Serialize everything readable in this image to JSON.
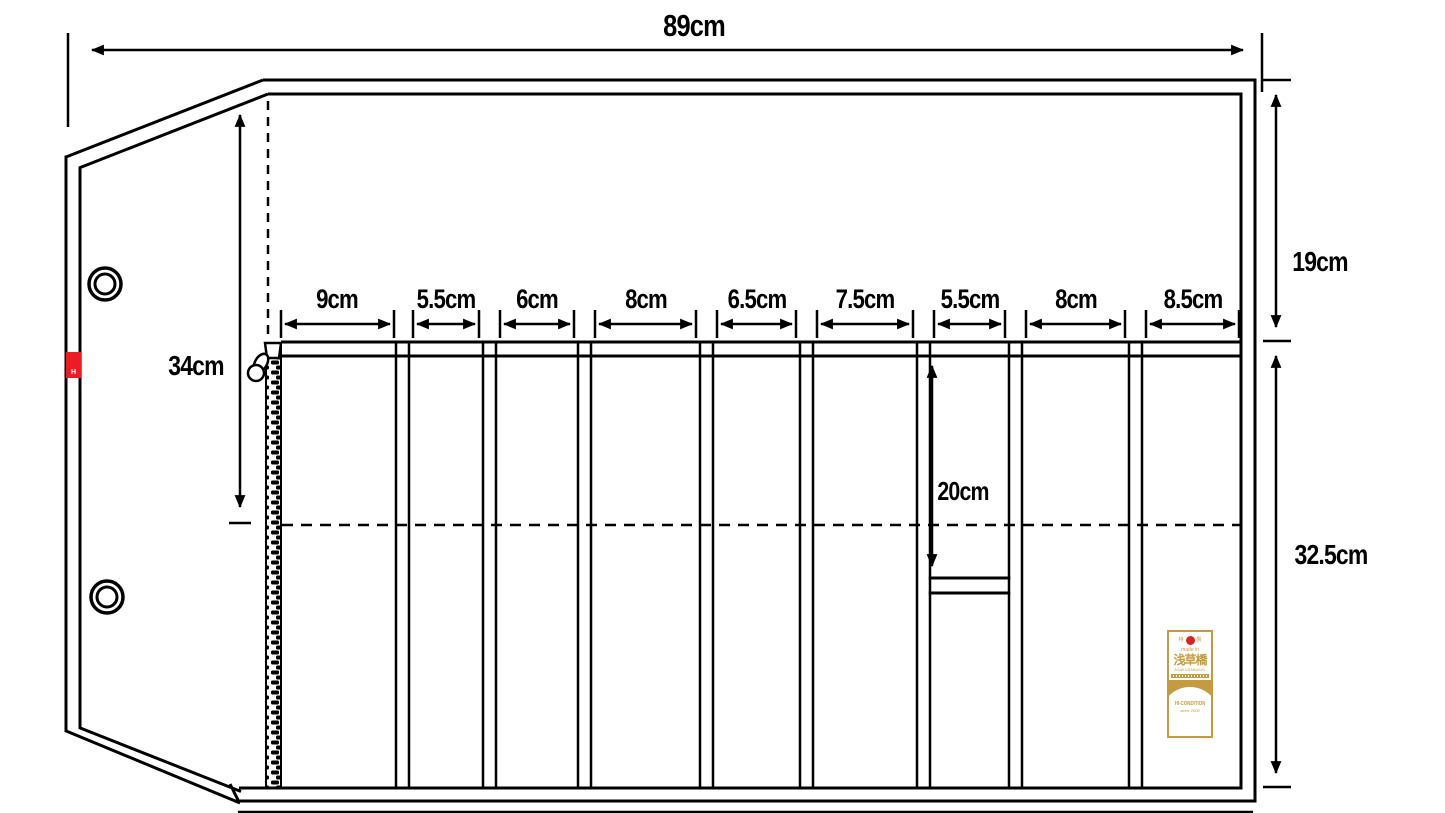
{
  "diagram": {
    "type": "technical-drawing",
    "subject": "knife roll / tool roll bag shown open with flap, zipper edge and pocket compartments",
    "units": "cm",
    "colors": {
      "line": "#000000",
      "background": "#FFFFFF",
      "accent_red": "#ED1C24",
      "label_gold": "#C49B3F"
    }
  },
  "dimensions": {
    "overall_width": "89cm",
    "flap_height": "34cm",
    "upper_section_height": "19cm",
    "lower_section_height": "32.5cm",
    "deep_pocket_height": "20cm",
    "pocket_widths": [
      {
        "label": "9cm"
      },
      {
        "label": "5.5cm"
      },
      {
        "label": "6cm"
      },
      {
        "label": "8cm"
      },
      {
        "label": "6.5cm"
      },
      {
        "label": "7.5cm"
      },
      {
        "label": "5.5cm"
      },
      {
        "label": "8cm"
      },
      {
        "label": "8.5cm"
      }
    ]
  },
  "red_tab": {
    "letter": "H"
  },
  "brand_label": {
    "seal_left": "特",
    "seal_right": "製",
    "made_in": "made in",
    "place_kanji": "浅草橋",
    "place_romaji": "ASAKUSABASHI",
    "brand_name": "HI-CONDITION",
    "since": "since 2009"
  }
}
